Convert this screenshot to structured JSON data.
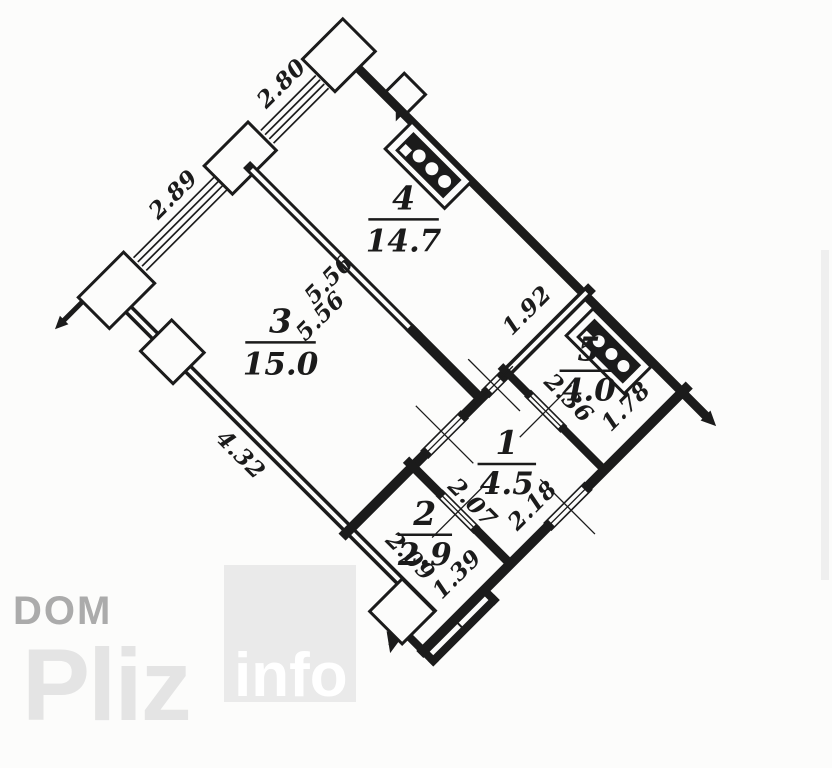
{
  "background": "#fcfcfb",
  "ink": "#1b1b1b",
  "rooms": [
    {
      "number": "1",
      "area": "4.5"
    },
    {
      "number": "2",
      "area": "2.9"
    },
    {
      "number": "3",
      "area": "15.0"
    },
    {
      "number": "4",
      "area": "14.7"
    },
    {
      "number": "5",
      "area": "4.0"
    }
  ],
  "dimensions": {
    "window_top": "2.80",
    "window_left": "2.89",
    "partition_a": "5.56",
    "partition_b": "5.56",
    "room4_bottom": "1.92",
    "room5_side": "2.36",
    "room5_bottom": "1.78",
    "left_wall": "4.32",
    "room1_left": "2.07",
    "entrance": "2.18",
    "room2_side": "2.09",
    "room2_bottom": "1.39"
  },
  "watermark": {
    "dom": "DOM",
    "pliz": "Pliz",
    "info": "info",
    "dom_color": "#ababab",
    "pliz_color": "#e4e4e4",
    "square_color": "#eaeaea",
    "info_color": "#ffffff"
  }
}
